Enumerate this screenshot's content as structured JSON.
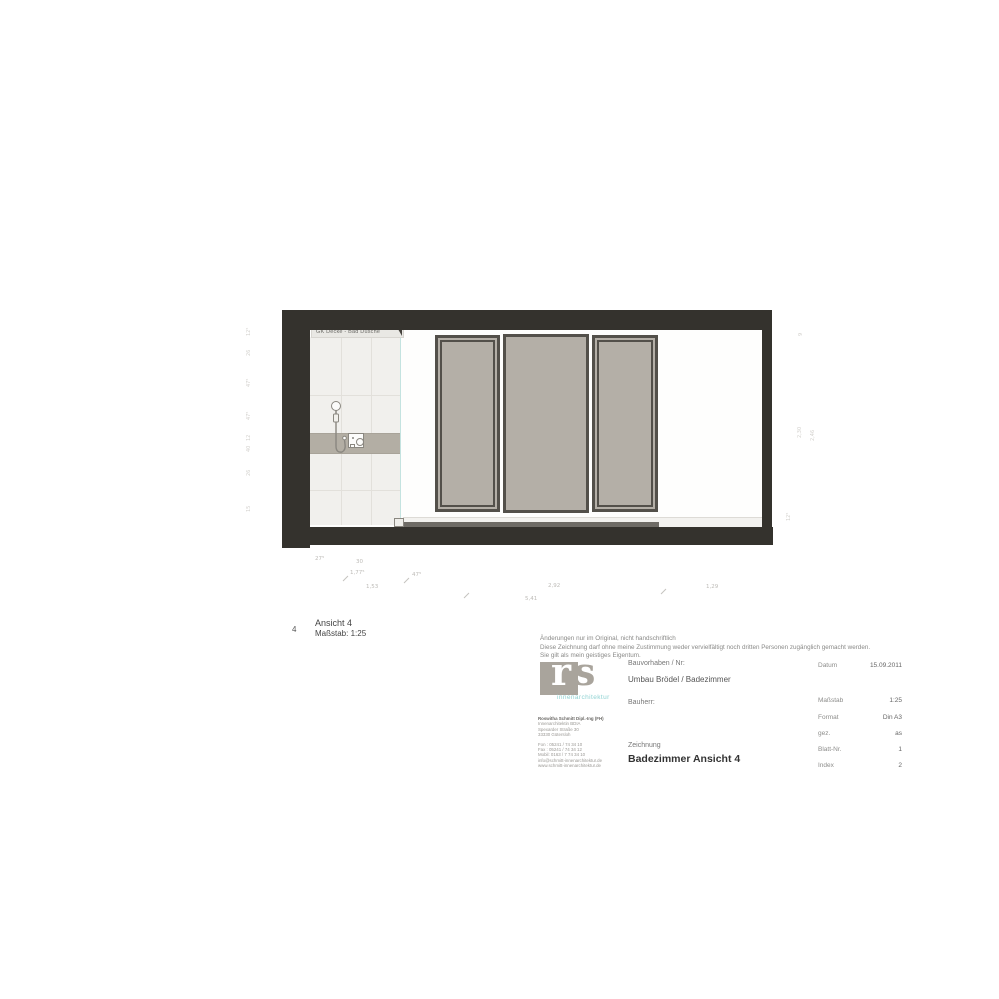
{
  "drawing": {
    "ceiling_label": "GK Decke - Bad Dusche",
    "caption": {
      "number": "4",
      "title": "Ansicht 4",
      "scale": "Maßstab: 1:25"
    }
  },
  "dims": {
    "b1": "27⁵",
    "b2": "30",
    "b3": "1,77⁵",
    "b4": "47⁵",
    "b5": "1,53",
    "b6": "2,92",
    "b7": "1,29",
    "b8": "5,41",
    "l1": "12⁵",
    "l2": "26",
    "l3": "47⁵",
    "l4": "47⁵",
    "l5": "12",
    "l6": "40",
    "l7": "26",
    "l8": "15",
    "r1": "9",
    "r2": "2,30",
    "r3": "2,46",
    "r4": "12⁵"
  },
  "titleblock": {
    "disclaimer": [
      "Änderungen nur im Original, nicht handschriftlich",
      "Diese Zeichnung darf ohne meine Zustimmung weder vervielfältigt noch dritten Personen zugänglich gemacht werden.",
      "Sie gilt als mein geistiges Eigentum."
    ],
    "logo": {
      "r": "r",
      "s": "s",
      "subtitle": "innenarchitektur"
    },
    "address": [
      "Roswitha Schmitt Dipl.-Ing (FH)",
      "Innenarchitektin BDIA",
      "Spexarder Straße 30",
      "33330 Gütersloh",
      "Fon : 05241 / 74 34 10",
      "Fax : 05241 / 74 34 12",
      "Mobil: 0163 / 7 74 34 10",
      "info@schmitt-innenarchitektur.de",
      "www.schmitt-innenarchitektur.de"
    ],
    "fields": {
      "bauvorhaben_label": "Bauvorhaben / Nr:",
      "bauvorhaben_value": "Umbau Brödel / Badezimmer",
      "bauherr_label": "Bauherr:",
      "zeichnung_label": "Zeichnung",
      "zeichnung_value": "Badezimmer Ansicht  4"
    },
    "meta": [
      {
        "label": "Datum",
        "value": "15.09.2011"
      },
      {
        "label": "Maßstab",
        "value": "1:25"
      },
      {
        "label": "Format",
        "value": "Din A3"
      },
      {
        "label": "gez.",
        "value": "as"
      },
      {
        "label": "Blatt-Nr.",
        "value": "1"
      },
      {
        "label": "Index",
        "value": "2"
      }
    ]
  }
}
